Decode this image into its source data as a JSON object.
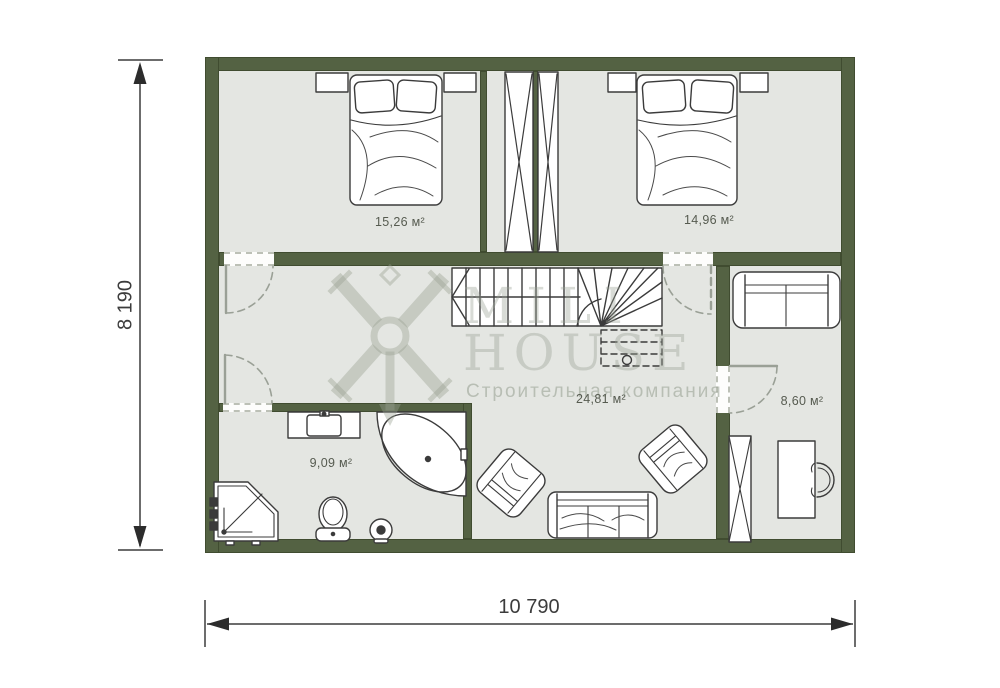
{
  "plan": {
    "type": "second-floor-plan",
    "watermark": {
      "line1": "MILI",
      "line2": "HOUSE",
      "tagline": "Строительная компания"
    },
    "dimensions": {
      "height_label": "8 190",
      "width_label": "10 790"
    },
    "rooms": [
      {
        "id": "bedroom-1",
        "area": "15,26 м²"
      },
      {
        "id": "bedroom-2",
        "area": "14,96 м²"
      },
      {
        "id": "hall",
        "area": "24,81 м²"
      },
      {
        "id": "bathroom",
        "area": "9,09 м²"
      },
      {
        "id": "study",
        "area": "8,60 м²"
      }
    ],
    "furniture": [
      "double-bed",
      "nightstand",
      "ventilation-shaft",
      "stairs",
      "loveseat-sofa",
      "wardrobe",
      "desk",
      "desk-chair",
      "three-seat-sofa",
      "armchair",
      "corner-bathtub",
      "washbasin-vanity",
      "toilet",
      "floor-drain",
      "shower-cabin"
    ],
    "colors": {
      "wall": "#546243",
      "floor": "#e4e6e2",
      "line": "#3b3b3b",
      "watermark": "#98a092"
    }
  }
}
